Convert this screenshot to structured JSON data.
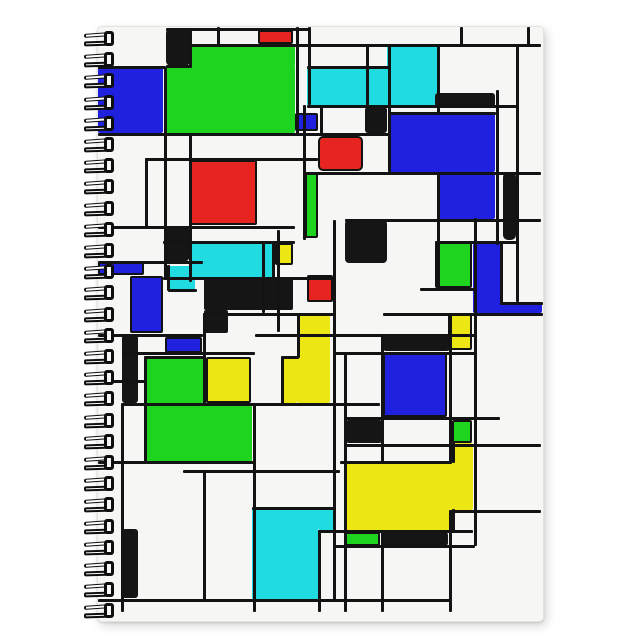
{
  "scene": {
    "description": "spiral notebook with abstract squares design cover",
    "canvas": {
      "width": 644,
      "height": 644,
      "background": "#ffffff"
    },
    "cover": {
      "x": 97,
      "y": 26,
      "width": 445,
      "height": 594,
      "background": "#f6f6f4",
      "edge_color": "#e3e3e0"
    },
    "spiral": {
      "count": 28,
      "x": 84,
      "start_y": 31,
      "spacing": 21.2,
      "coil_width": 32,
      "coil_height": 16,
      "wire_color": "#0e0e0e",
      "hole_fill": "#f7f7f6"
    },
    "palette": {
      "blue": "#2020df",
      "green": "#1fd41f",
      "red": "#e62420",
      "cyan": "#20dbe0",
      "yellow": "#ece613",
      "black": "#151515"
    },
    "rects": [
      {
        "n": "blue-big-left-square",
        "c": "blue",
        "x": 98,
        "y": 67,
        "w": 65,
        "h": 66,
        "o": false
      },
      {
        "n": "black-square-top-left",
        "c": "black",
        "x": 166,
        "y": 28,
        "w": 24,
        "h": 38,
        "o": false,
        "r": 5
      },
      {
        "n": "green-big-top-upper",
        "c": "green",
        "x": 190,
        "y": 46,
        "w": 105,
        "h": 20,
        "o": false
      },
      {
        "n": "green-big-top-lower",
        "c": "green",
        "x": 166,
        "y": 65,
        "w": 129,
        "h": 68,
        "o": false
      },
      {
        "n": "red-small-top-bar",
        "c": "red",
        "x": 258,
        "y": 30,
        "w": 35,
        "h": 14,
        "o": true
      },
      {
        "n": "cyan-top-right-part",
        "c": "cyan",
        "x": 387,
        "y": 46,
        "w": 50,
        "h": 60,
        "o": false
      },
      {
        "n": "cyan-top-left-part",
        "c": "cyan",
        "x": 307,
        "y": 67,
        "w": 80,
        "h": 39,
        "o": false
      },
      {
        "n": "black-bar-top-right",
        "c": "black",
        "x": 435,
        "y": 93,
        "w": 60,
        "h": 14,
        "o": false,
        "r": 3
      },
      {
        "n": "blue-big-right-upper",
        "c": "blue",
        "x": 388,
        "y": 113,
        "w": 107,
        "h": 59,
        "o": false
      },
      {
        "n": "blue-big-right-lower",
        "c": "blue",
        "x": 437,
        "y": 172,
        "w": 58,
        "h": 47,
        "o": false
      },
      {
        "n": "black-small-top-mid",
        "c": "black",
        "x": 365,
        "y": 107,
        "w": 22,
        "h": 26,
        "o": false,
        "r": 3
      },
      {
        "n": "blue-small-top-mid",
        "c": "blue",
        "x": 295,
        "y": 113,
        "w": 23,
        "h": 18,
        "o": true
      },
      {
        "n": "red-rounded-square-mid",
        "c": "red",
        "x": 318,
        "y": 136,
        "w": 45,
        "h": 35,
        "o": true,
        "r": 5
      },
      {
        "n": "red-big-left-square",
        "c": "red",
        "x": 190,
        "y": 160,
        "w": 67,
        "h": 65,
        "o": true
      },
      {
        "n": "green-vbar-mid",
        "c": "green",
        "x": 305,
        "y": 172,
        "w": 13,
        "h": 66,
        "o": true
      },
      {
        "n": "black-vbar-right",
        "c": "black",
        "x": 503,
        "y": 172,
        "w": 13,
        "h": 68,
        "o": false,
        "r": 5
      },
      {
        "n": "black-square-left-2",
        "c": "black",
        "x": 164,
        "y": 227,
        "w": 25,
        "h": 34,
        "o": false,
        "r": 3
      },
      {
        "n": "cyan-mid-main",
        "c": "cyan",
        "x": 191,
        "y": 243,
        "w": 81,
        "h": 35,
        "o": false
      },
      {
        "n": "cyan-mid-ext",
        "c": "cyan",
        "x": 168,
        "y": 266,
        "w": 27,
        "h": 24,
        "o": false
      },
      {
        "n": "yellow-small-mid",
        "c": "yellow",
        "x": 275,
        "y": 243,
        "w": 18,
        "h": 22,
        "o": true
      },
      {
        "n": "blue-hbar-left",
        "c": "blue",
        "x": 98,
        "y": 262,
        "w": 46,
        "h": 13,
        "o": true
      },
      {
        "n": "blue-vrect-left",
        "c": "blue",
        "x": 130,
        "y": 276,
        "w": 33,
        "h": 57,
        "o": true
      },
      {
        "n": "black-L-center-a",
        "c": "black",
        "x": 204,
        "y": 277,
        "w": 89,
        "h": 33,
        "o": false
      },
      {
        "n": "black-L-center-b",
        "c": "black",
        "x": 204,
        "y": 310,
        "w": 24,
        "h": 23,
        "o": false
      },
      {
        "n": "red-small-right-mid",
        "c": "red",
        "x": 307,
        "y": 275,
        "w": 26,
        "h": 27,
        "o": true
      },
      {
        "n": "black-square-mid-right",
        "c": "black",
        "x": 345,
        "y": 220,
        "w": 42,
        "h": 43,
        "o": false,
        "r": 4
      },
      {
        "n": "green-small-right",
        "c": "green",
        "x": 435,
        "y": 242,
        "w": 37,
        "h": 46,
        "o": true
      },
      {
        "n": "blue-vrect-right",
        "c": "blue",
        "x": 473,
        "y": 243,
        "w": 27,
        "h": 70,
        "o": false
      },
      {
        "n": "blue-hbar-right",
        "c": "blue",
        "x": 497,
        "y": 302,
        "w": 45,
        "h": 11,
        "o": false
      },
      {
        "n": "yellow-stair-right",
        "c": "yellow",
        "x": 297,
        "y": 315,
        "w": 33,
        "h": 88,
        "o": false
      },
      {
        "n": "yellow-stair-left",
        "c": "yellow",
        "x": 282,
        "y": 357,
        "w": 15,
        "h": 46,
        "o": false
      },
      {
        "n": "yellow-small-right",
        "c": "yellow",
        "x": 448,
        "y": 313,
        "w": 24,
        "h": 37,
        "o": true
      },
      {
        "n": "black-vbar-left-1",
        "c": "black",
        "x": 122,
        "y": 335,
        "w": 16,
        "h": 68,
        "o": false,
        "r": 3
      },
      {
        "n": "blue-small-mid-left",
        "c": "blue",
        "x": 165,
        "y": 337,
        "w": 37,
        "h": 16,
        "o": true
      },
      {
        "n": "black-hbar-mid",
        "c": "black",
        "x": 383,
        "y": 335,
        "w": 67,
        "h": 16,
        "o": false,
        "r": 3
      },
      {
        "n": "blue-big-bottom",
        "c": "blue",
        "x": 383,
        "y": 352,
        "w": 64,
        "h": 65,
        "o": true
      },
      {
        "n": "green-L-upper",
        "c": "green",
        "x": 145,
        "y": 357,
        "w": 58,
        "h": 48,
        "o": false
      },
      {
        "n": "green-L-lower",
        "c": "green",
        "x": 145,
        "y": 405,
        "w": 107,
        "h": 57,
        "o": false
      },
      {
        "n": "yellow-square-bottom-left",
        "c": "yellow",
        "x": 206,
        "y": 357,
        "w": 45,
        "h": 46,
        "o": true
      },
      {
        "n": "black-small-bottom-mid",
        "c": "black",
        "x": 345,
        "y": 420,
        "w": 38,
        "h": 23,
        "o": false,
        "r": 4
      },
      {
        "n": "green-small-bottom-right",
        "c": "green",
        "x": 452,
        "y": 420,
        "w": 20,
        "h": 23,
        "o": true
      },
      {
        "n": "yellow-col-bottom-right",
        "c": "yellow",
        "x": 452,
        "y": 443,
        "w": 21,
        "h": 67,
        "o": false
      },
      {
        "n": "yellow-big-bottom",
        "c": "yellow",
        "x": 345,
        "y": 462,
        "w": 107,
        "h": 68,
        "o": false
      },
      {
        "n": "green-small-bottom",
        "c": "green",
        "x": 345,
        "y": 532,
        "w": 35,
        "h": 14,
        "o": true
      },
      {
        "n": "black-hbar-bottom",
        "c": "black",
        "x": 383,
        "y": 532,
        "w": 65,
        "h": 14,
        "o": false,
        "r": 3
      },
      {
        "n": "cyan-big-bottom",
        "c": "cyan",
        "x": 252,
        "y": 508,
        "w": 66,
        "h": 92,
        "o": false
      },
      {
        "n": "cyan-bottom-ext",
        "c": "cyan",
        "x": 318,
        "y": 508,
        "w": 17,
        "h": 22,
        "o": false
      },
      {
        "n": "black-vbar-left-2",
        "c": "black",
        "x": 122,
        "y": 529,
        "w": 16,
        "h": 69,
        "o": false,
        "r": 3
      }
    ],
    "lines": [
      {
        "d": "h",
        "x": 166,
        "y": 28,
        "l": 144
      },
      {
        "d": "h",
        "x": 190,
        "y": 44,
        "l": 351
      },
      {
        "d": "h",
        "x": 98,
        "y": 66,
        "l": 68
      },
      {
        "d": "h",
        "x": 166,
        "y": 65,
        "l": 26
      },
      {
        "d": "h",
        "x": 307,
        "y": 66,
        "l": 82
      },
      {
        "d": "h",
        "x": 307,
        "y": 105,
        "l": 210
      },
      {
        "d": "h",
        "x": 388,
        "y": 112,
        "l": 108
      },
      {
        "d": "h",
        "x": 98,
        "y": 133,
        "l": 292
      },
      {
        "d": "h",
        "x": 145,
        "y": 158,
        "l": 173
      },
      {
        "d": "h",
        "x": 303,
        "y": 172,
        "l": 238
      },
      {
        "d": "h",
        "x": 345,
        "y": 219,
        "l": 196
      },
      {
        "d": "h",
        "x": 98,
        "y": 226,
        "l": 197
      },
      {
        "d": "h",
        "x": 163,
        "y": 241,
        "l": 132
      },
      {
        "d": "h",
        "x": 435,
        "y": 241,
        "l": 82
      },
      {
        "d": "h",
        "x": 98,
        "y": 261,
        "l": 105
      },
      {
        "d": "h",
        "x": 163,
        "y": 277,
        "l": 172
      },
      {
        "d": "h",
        "x": 168,
        "y": 289,
        "l": 29
      },
      {
        "d": "h",
        "x": 420,
        "y": 288,
        "l": 55
      },
      {
        "d": "h",
        "x": 500,
        "y": 302,
        "l": 43
      },
      {
        "d": "h",
        "x": 383,
        "y": 313,
        "l": 160
      },
      {
        "d": "h",
        "x": 203,
        "y": 313,
        "l": 132
      },
      {
        "d": "h",
        "x": 98,
        "y": 334,
        "l": 105
      },
      {
        "d": "h",
        "x": 255,
        "y": 334,
        "l": 220
      },
      {
        "d": "h",
        "x": 122,
        "y": 352,
        "l": 133
      },
      {
        "d": "h",
        "x": 335,
        "y": 352,
        "l": 140
      },
      {
        "d": "h",
        "x": 145,
        "y": 356,
        "l": 60
      },
      {
        "d": "h",
        "x": 282,
        "y": 356,
        "l": 17
      },
      {
        "d": "h",
        "x": 98,
        "y": 380,
        "l": 47
      },
      {
        "d": "h",
        "x": 122,
        "y": 403,
        "l": 258
      },
      {
        "d": "h",
        "x": 345,
        "y": 417,
        "l": 155
      },
      {
        "d": "h",
        "x": 345,
        "y": 444,
        "l": 196
      },
      {
        "d": "h",
        "x": 98,
        "y": 461,
        "l": 157
      },
      {
        "d": "h",
        "x": 340,
        "y": 461,
        "l": 112
      },
      {
        "d": "h",
        "x": 183,
        "y": 470,
        "l": 157
      },
      {
        "d": "h",
        "x": 252,
        "y": 507,
        "l": 84
      },
      {
        "d": "h",
        "x": 450,
        "y": 510,
        "l": 91
      },
      {
        "d": "h",
        "x": 318,
        "y": 530,
        "l": 155
      },
      {
        "d": "h",
        "x": 335,
        "y": 545,
        "l": 140
      },
      {
        "d": "h",
        "x": 98,
        "y": 599,
        "l": 352
      },
      {
        "d": "v",
        "x": 121,
        "y": 403,
        "l": 209
      },
      {
        "d": "v",
        "x": 144,
        "y": 356,
        "l": 107
      },
      {
        "d": "v",
        "x": 145,
        "y": 158,
        "l": 69
      },
      {
        "d": "v",
        "x": 164,
        "y": 67,
        "l": 211
      },
      {
        "d": "v",
        "x": 167,
        "y": 265,
        "l": 26
      },
      {
        "d": "v",
        "x": 189,
        "y": 29,
        "l": 38
      },
      {
        "d": "v",
        "x": 189,
        "y": 133,
        "l": 149
      },
      {
        "d": "v",
        "x": 203,
        "y": 313,
        "l": 92
      },
      {
        "d": "v",
        "x": 203,
        "y": 470,
        "l": 130
      },
      {
        "d": "v",
        "x": 217,
        "y": 27,
        "l": 19
      },
      {
        "d": "v",
        "x": 253,
        "y": 405,
        "l": 207
      },
      {
        "d": "v",
        "x": 262,
        "y": 242,
        "l": 71
      },
      {
        "d": "v",
        "x": 272,
        "y": 242,
        "l": 37
      },
      {
        "d": "v",
        "x": 277,
        "y": 230,
        "l": 102
      },
      {
        "d": "v",
        "x": 281,
        "y": 356,
        "l": 48
      },
      {
        "d": "v",
        "x": 296,
        "y": 27,
        "l": 108
      },
      {
        "d": "v",
        "x": 297,
        "y": 314,
        "l": 44
      },
      {
        "d": "v",
        "x": 303,
        "y": 105,
        "l": 135
      },
      {
        "d": "v",
        "x": 308,
        "y": 27,
        "l": 78
      },
      {
        "d": "v",
        "x": 318,
        "y": 530,
        "l": 82
      },
      {
        "d": "v",
        "x": 320,
        "y": 107,
        "l": 28
      },
      {
        "d": "v",
        "x": 333,
        "y": 220,
        "l": 380
      },
      {
        "d": "v",
        "x": 344,
        "y": 352,
        "l": 260
      },
      {
        "d": "v",
        "x": 366,
        "y": 46,
        "l": 61
      },
      {
        "d": "v",
        "x": 381,
        "y": 335,
        "l": 127
      },
      {
        "d": "v",
        "x": 381,
        "y": 530,
        "l": 82
      },
      {
        "d": "v",
        "x": 388,
        "y": 44,
        "l": 128
      },
      {
        "d": "v",
        "x": 437,
        "y": 44,
        "l": 69
      },
      {
        "d": "v",
        "x": 437,
        "y": 172,
        "l": 116
      },
      {
        "d": "v",
        "x": 449,
        "y": 313,
        "l": 149
      },
      {
        "d": "v",
        "x": 449,
        "y": 510,
        "l": 102
      },
      {
        "d": "v",
        "x": 452,
        "y": 442,
        "l": 21
      },
      {
        "d": "v",
        "x": 452,
        "y": 509,
        "l": 22
      },
      {
        "d": "v",
        "x": 460,
        "y": 27,
        "l": 19
      },
      {
        "d": "v",
        "x": 474,
        "y": 218,
        "l": 328
      },
      {
        "d": "v",
        "x": 496,
        "y": 90,
        "l": 155
      },
      {
        "d": "v",
        "x": 500,
        "y": 243,
        "l": 60
      },
      {
        "d": "v",
        "x": 516,
        "y": 44,
        "l": 258
      },
      {
        "d": "v",
        "x": 527,
        "y": 27,
        "l": 19
      }
    ]
  }
}
